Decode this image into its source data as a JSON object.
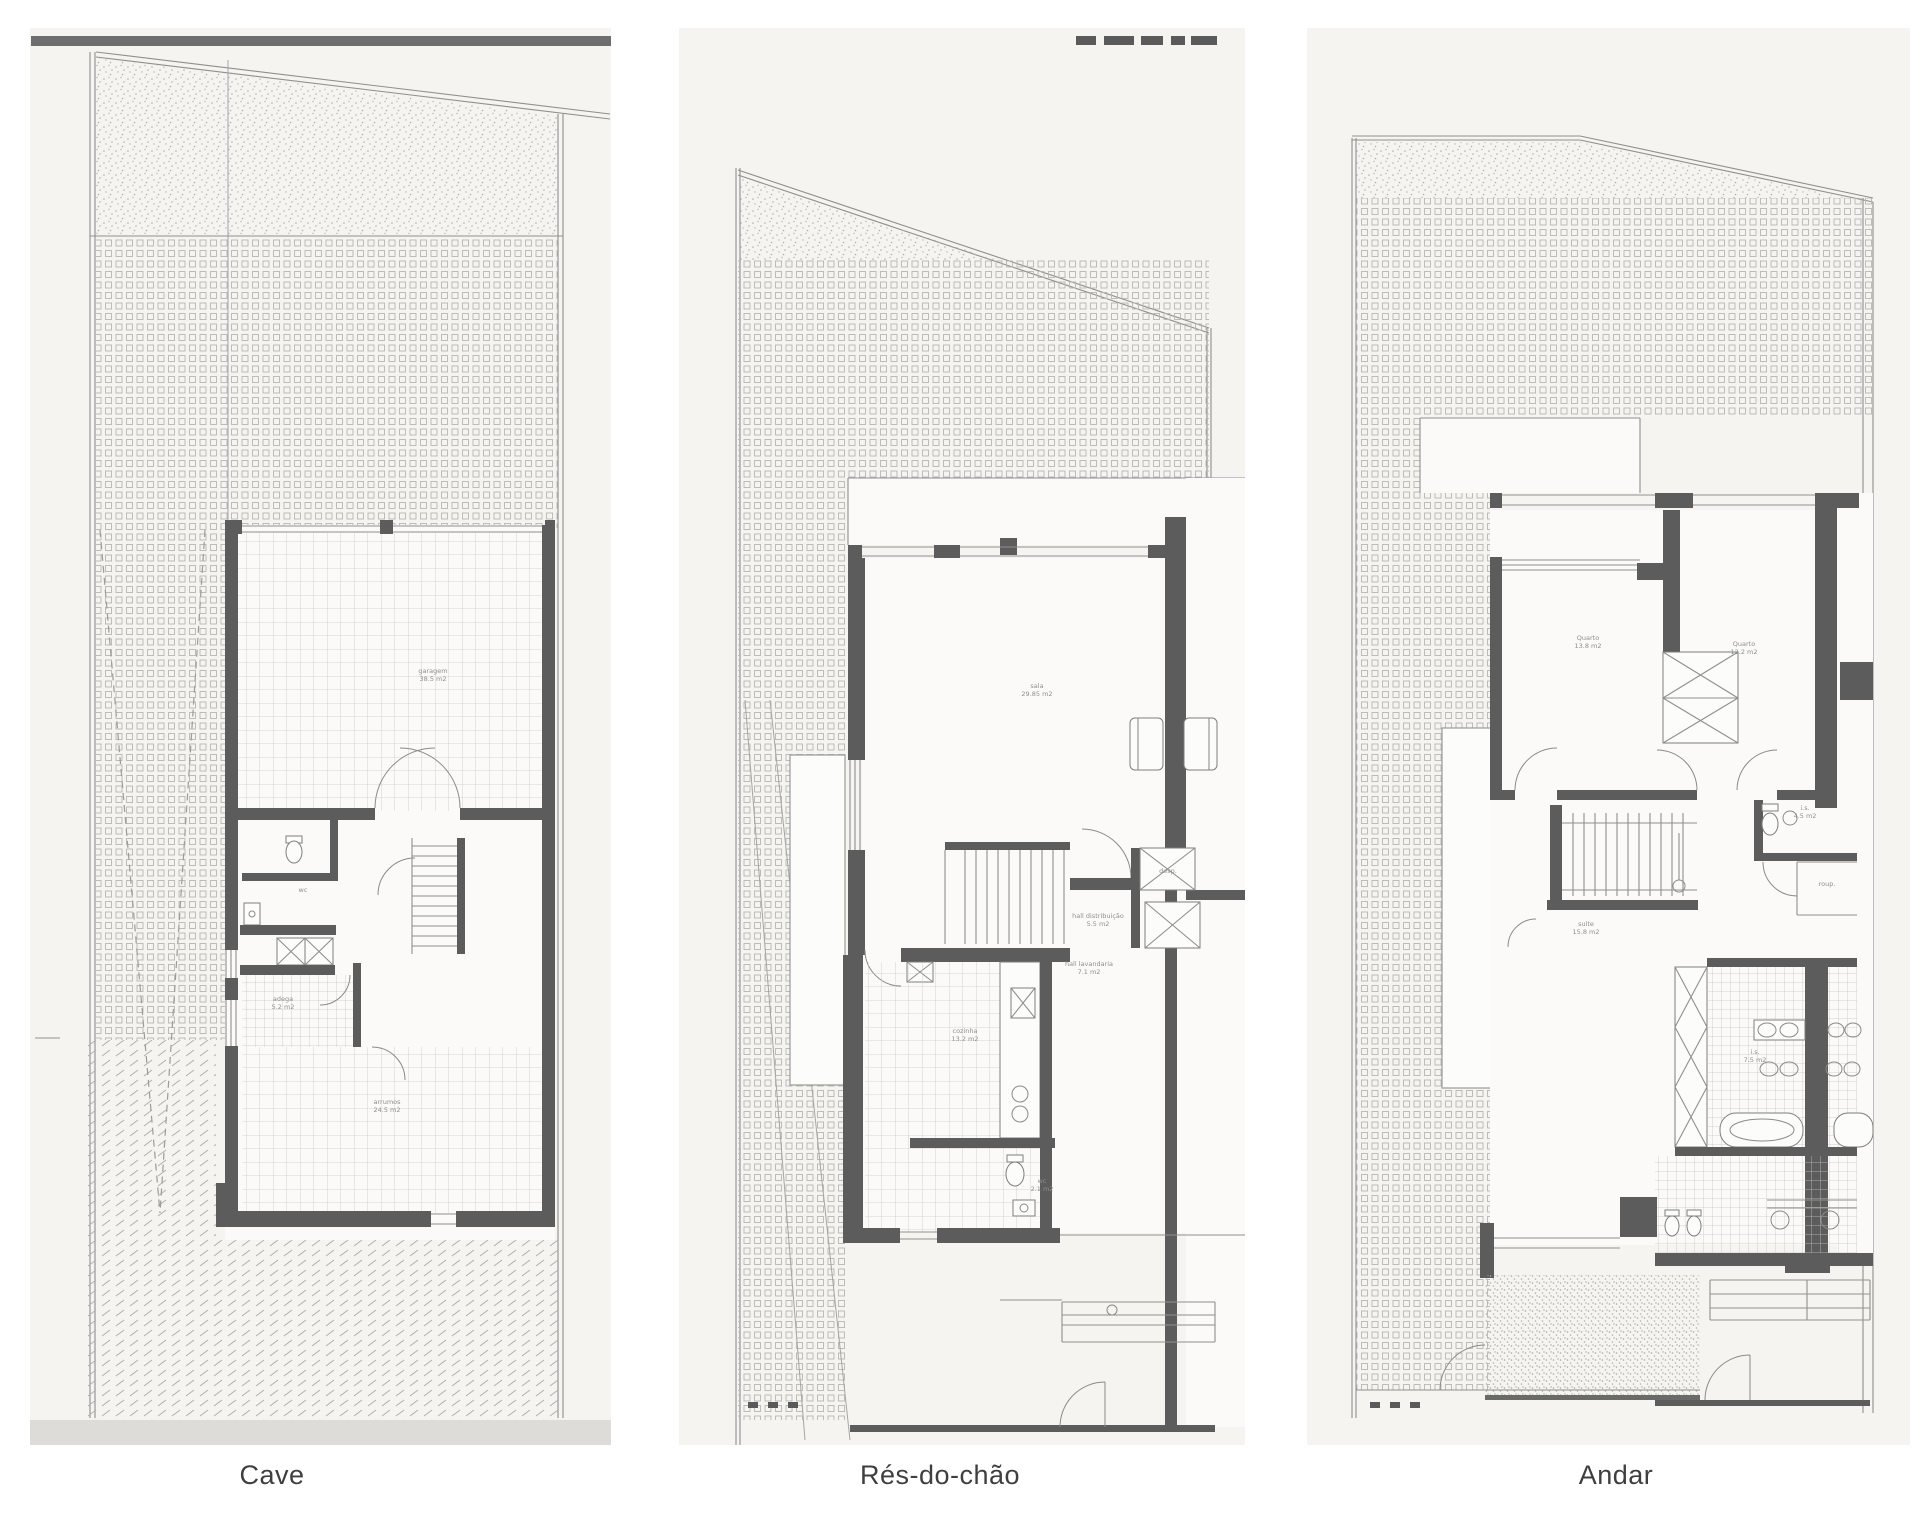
{
  "panels": [
    {
      "id": "cave",
      "caption": "Cave"
    },
    {
      "id": "res-do-chao",
      "caption": "Rés-do-chão"
    },
    {
      "id": "andar",
      "caption": "Andar"
    }
  ],
  "rooms": {
    "cave": {
      "garagem": {
        "name": "garagem",
        "area": "38.5 m2"
      },
      "wc": {
        "name": "wc",
        "area": "2.1 m2"
      },
      "adega": {
        "name": "adega",
        "area": "5.2 m2"
      },
      "arrumos": {
        "name": "arrumos",
        "area": "24.5 m2"
      }
    },
    "resDoChao": {
      "sala": {
        "name": "sala",
        "area": "29.85 m2"
      },
      "hallDistribuicao": {
        "name": "hall distribuição",
        "area": "5.5 m2"
      },
      "hallLavandaria": {
        "name": "hall lavandaria",
        "area": "7.1 m2"
      },
      "cozinha": {
        "name": "cozinha",
        "area": "13.2 m2"
      },
      "wc": {
        "name": "wc",
        "area": "2.1 m2"
      },
      "despensa": {
        "name": "desp.",
        "area": "1.5 m2"
      }
    },
    "andar": {
      "quarto1": {
        "name": "Quarto",
        "area": "13.8 m2"
      },
      "quarto2": {
        "name": "Quarto",
        "area": "12.2 m2"
      },
      "suite": {
        "name": "suite",
        "area": "15.8 m2"
      },
      "is1": {
        "name": "i.s.",
        "area": "4.5 m2"
      },
      "is2": {
        "name": "i.s.",
        "area": "7.5 m2"
      },
      "roupeiro": {
        "name": "roup.",
        "area": "1.5 m2"
      }
    }
  },
  "colors": {
    "wall": "#5c5c5c",
    "thin_line": "#8f8f8c",
    "scan_background": "#f5f4f1",
    "room_fill": "#fbfaf8",
    "caption_text": "#3f3f3f",
    "top_bar": "#6e6e6e"
  }
}
